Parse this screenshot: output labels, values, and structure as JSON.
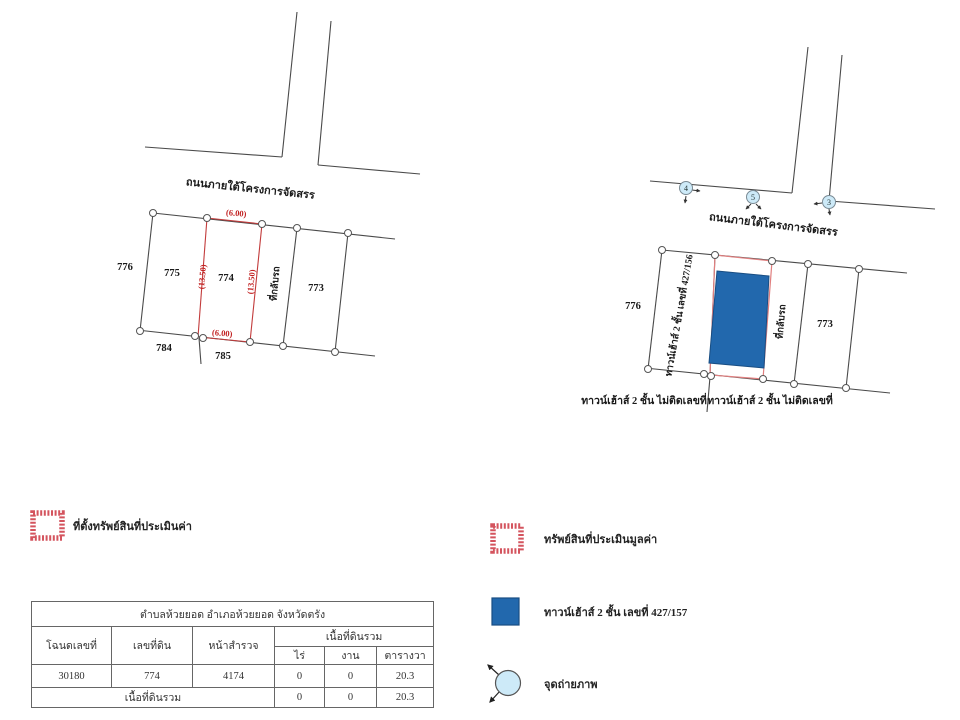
{
  "left_map": {
    "road_label": "ถนนภายใต้โครงการจัดสรร",
    "parcels": {
      "p776": "776",
      "p775": "775",
      "p774": "774",
      "p773": "773",
      "p784": "784",
      "p785": "785"
    },
    "dims": {
      "top": "(6.00)",
      "bottom": "(6.00)",
      "left": "(13.50)",
      "right": "(13.50)"
    },
    "turnaround_label": "ที่กลับรถ"
  },
  "right_map": {
    "road_label": "ถนนภายใต้โครงการจัดสรร",
    "points": [
      "4",
      "5",
      "3"
    ],
    "parcels": {
      "p776": "776",
      "p773": "773"
    },
    "turnaround_label": "ที่กลับรถ",
    "building_vertical_label": "ทาวน์เฮ้าส์ 2 ชั้น เลขที่ 427/156",
    "bottom_label_left": "ทาวน์เฮ้าส์ 2 ชั้น ไม่ติดเลขที่",
    "bottom_label_right": "ทาวน์เฮ้าส์ 2 ชั้น ไม่ติดเลขที่"
  },
  "legend_left": {
    "appraised_location_label": "ที่ตั้งทรัพย์สินที่ประเมินค่า"
  },
  "legend_right": {
    "appraised_property_label": "ทรัพย์สินที่ประเมินมูลค่า",
    "townhouse_label": "ทาวน์เฮ้าส์ 2 ชั้น เลขที่ 427/157",
    "photo_point_label": "จุดถ่ายภาพ"
  },
  "table": {
    "title": "ตำบลห้วยยอด อำเภอห้วยยอด จังหวัดตรัง",
    "headers": {
      "deed_no": "โฉนดเลขที่",
      "land_no": "เลขที่ดิน",
      "survey_page": "หน้าสำรวจ",
      "total_area": "เนื้อที่ดินรวม",
      "rai": "ไร่",
      "ngan": "งาน",
      "sq_wa": "ตารางวา"
    },
    "data_row": [
      "30180",
      "774",
      "4174",
      "0",
      "0",
      "20.3"
    ],
    "total_row_label": "เนื้อที่ดินรวม",
    "total_row": [
      "0",
      "0",
      "20.3"
    ]
  },
  "colors": {
    "parcel_red": "#c23b3b",
    "building_blue": "#2268ad",
    "photo_point_fill": "#cdeaf8",
    "line": "#4a4a4a"
  }
}
